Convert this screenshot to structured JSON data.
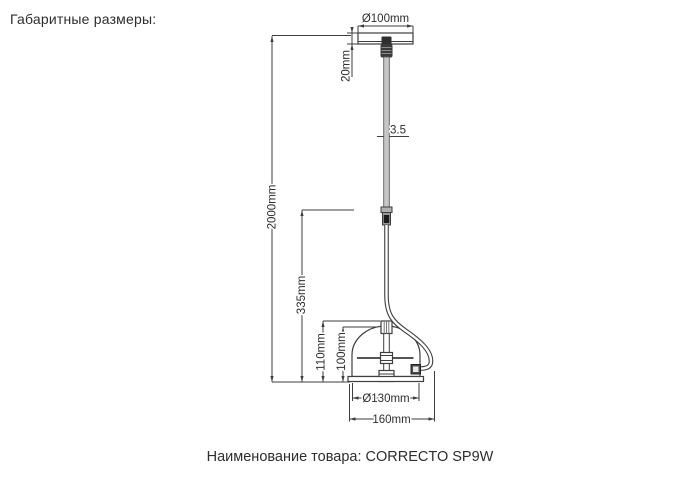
{
  "header": {
    "title": "Габаритные размеры:"
  },
  "footer": {
    "caption": "Наименование товара: CORRECTO SP9W"
  },
  "drawing": {
    "product_name": "CORRECTO SP9W",
    "dimensions": {
      "canopy_diameter": "Ø100mm",
      "canopy_height": "20mm",
      "cable_diameter": "3.5",
      "suspension_length": "2000mm",
      "rod_length": "335mm",
      "shade_outer_height": "110mm",
      "shade_height": "100mm",
      "shade_diameter": "Ø130mm",
      "overall_width": "160mm"
    }
  }
}
